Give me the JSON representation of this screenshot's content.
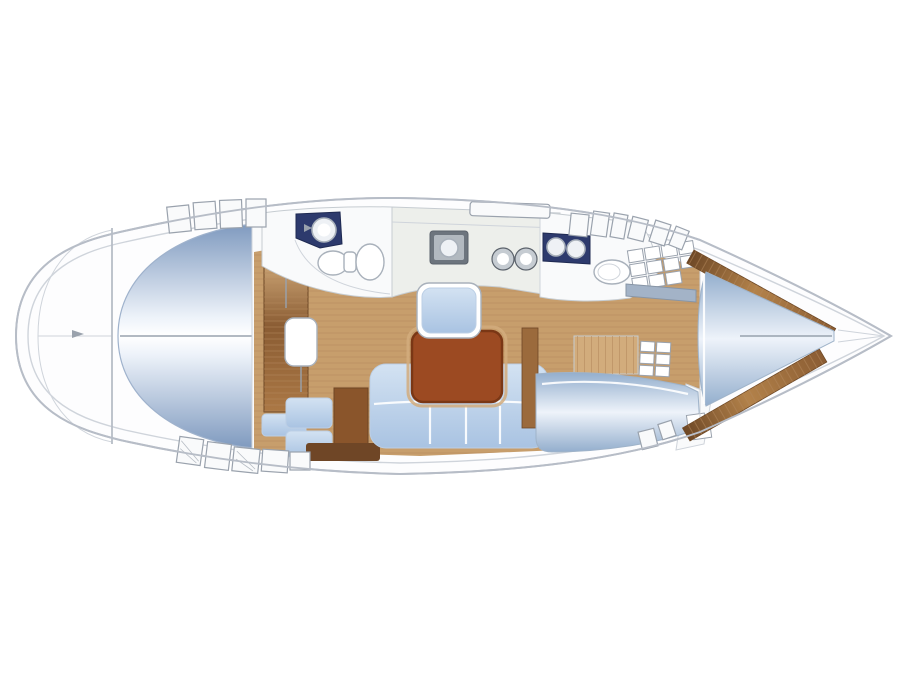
{
  "diagram": {
    "kind": "sailboat-interior-floor-plan",
    "orientation": "bow-right-stern-left",
    "rooms": [
      "stern-platform",
      "aft-double-berth",
      "companionway",
      "forward-head",
      "galley",
      "aft-head",
      "salon",
      "starboard-cabin",
      "v-berth-cabin"
    ],
    "fixtures": [
      "washbasin",
      "toilet",
      "stove",
      "twin-sinks",
      "salon-table",
      "u-settee",
      "seat",
      "nav-cabinet",
      "steps",
      "deck-hatches",
      "shelves",
      "dresser"
    ]
  },
  "colors": {
    "bg": "#ffffff",
    "hullFill": "#fdfdfe",
    "hullStroke": "#b7bdc7",
    "deckLine": "#cfd4db",
    "deckWhite": "#f9fafb",
    "hatchStroke": "#9aa2ad",
    "seam": "#98a2ae",
    "white": "#ffffff",
    "blueLight": "#eef3fa",
    "domeBlue": "#7f9abf",
    "domeEdge": "#9fb2cc",
    "berthBlue": "#93aecd",
    "berthEdge": "#9fb3c9",
    "cushion": "#a9c3e2",
    "cushionLight": "#d3e2f2",
    "cushionEdge": "#bccfe5",
    "woodFloor": "#c79e6c",
    "woodLine": "#b2865a",
    "woodDark": "#8a5c33",
    "woodMid": "#ab7845",
    "woodLight": "#d2ac7c",
    "table": "#9c4a22",
    "tableEdge": "#7a3715",
    "cabinetBrown": "#8a552b",
    "stripBrown": "#6f4626",
    "wall": "#9b6a3c",
    "shelfDark": "#6e4826",
    "shelfMid": "#b3824a",
    "navy": "#2d3a6d",
    "navyEdge": "#1f2a52",
    "ringWhite": "#eef1f5",
    "fixtureStroke": "#a9b1bb",
    "counter": "#edefeb",
    "counterStroke": "#c6ccd1",
    "stoveFrame": "#6d757e",
    "stoveEdge": "#5c636c",
    "stoveFace": "#b2b9c0",
    "sinkGray": "#c6ccd2",
    "barBlueGray": "#a3b3c7",
    "barEdge": "#8795a6",
    "louver": "#e3e9f0",
    "louverLine": "#a9b6c4"
  }
}
